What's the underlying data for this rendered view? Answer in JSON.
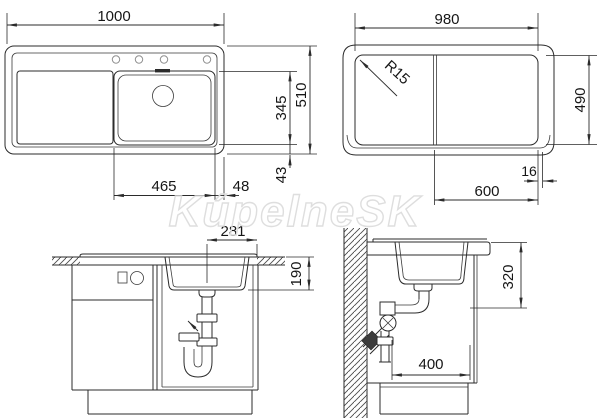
{
  "watermark": {
    "text": "KúpelneSK"
  },
  "top_view": {
    "overall_width": "1000",
    "bowl_width": "465",
    "bowl_to_edge": "48",
    "bowl_length": "345",
    "overall_depth": "510",
    "edge_gap": "43"
  },
  "underside_view": {
    "body_width": "980",
    "corner_radius": "R15",
    "body_depth": "490",
    "bowl_zone_width": "600",
    "edge_lip": "16"
  },
  "front_section": {
    "drain_to_edge": "281",
    "bowl_depth": "190"
  },
  "side_section": {
    "under_counter_depth": "320",
    "clearance_width": "400"
  }
}
